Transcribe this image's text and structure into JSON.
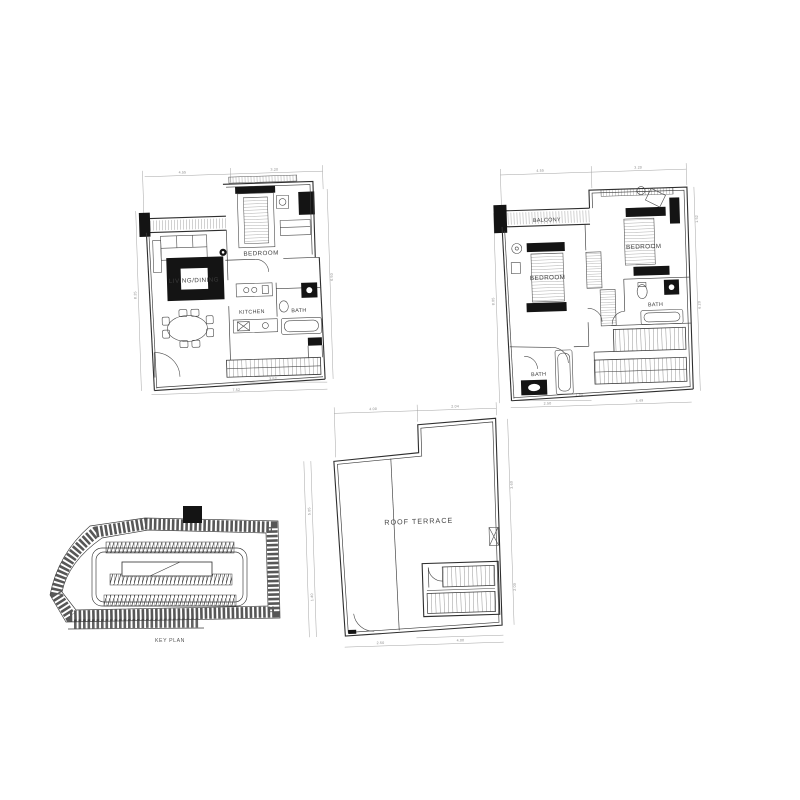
{
  "plans": {
    "living_level": {
      "rooms": {
        "living_dining": "LIVING/DINING",
        "bedroom": "BEDROOM",
        "kitchen": "KITCHEN",
        "bath": "BATH"
      },
      "dims": {
        "top_left": "4.55",
        "top_right": "3.20",
        "left": "8.25",
        "right": "6.50",
        "bottom": "7.52",
        "bottom_inner": "3.52"
      }
    },
    "bedroom_level": {
      "rooms": {
        "balcony": "BALCONY",
        "bedroom_left": "BEDROOM",
        "bedroom_right": "BEDROOM",
        "bath_upper": "BATH",
        "bath_lower": "BATH"
      },
      "dims": {
        "top_left": "4.55",
        "top_right": "3.20",
        "left": "8.05",
        "right_upper": "1.52",
        "right_lower": "6.20",
        "bottom_left": "2.50",
        "bottom_right": "4.49",
        "bottom_inner": "1.52"
      }
    },
    "roof_level": {
      "rooms": {
        "roof_terrace": "ROOF TERRACE"
      },
      "dims": {
        "top_left": "4.00",
        "top_right": "2.04",
        "left_upper": "5.05",
        "left_lower": "1.40",
        "right_upper": "3.60",
        "right_lower": "2.00",
        "bottom_left": "2.50",
        "bottom_right": "4.00"
      }
    }
  },
  "key_plan": {
    "label": "KEY PLAN"
  },
  "colors": {
    "paper": "#ffffff",
    "ink": "#2e2e2e",
    "dim_lines": "#8a8a8a",
    "solid_fill": "#141414"
  }
}
